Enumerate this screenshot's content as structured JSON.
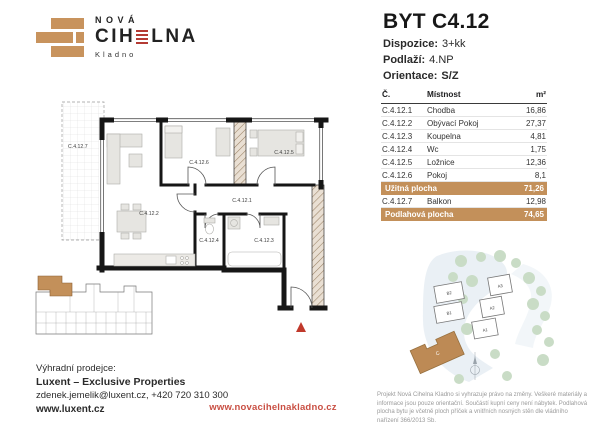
{
  "logo": {
    "line1": "NOVÁ",
    "line2_left": "CIH",
    "line2_right": "LNA",
    "line3": "Kladno"
  },
  "header": {
    "title": "BYT C4.12",
    "dispozice_label": "Dispozice:",
    "dispozice_value": "3+kk",
    "podlazi_label": "Podlaží:",
    "podlazi_value": "4.NP",
    "orientace_label": "Orientace:",
    "orientace_value": "S/Z"
  },
  "table": {
    "col_no": "Č.",
    "col_room": "Místnost",
    "col_area": "m²",
    "rows": [
      {
        "no": "C.4.12.1",
        "room": "Chodba",
        "area": "16,86"
      },
      {
        "no": "C.4.12.2",
        "room": "Obývací Pokoj",
        "area": "27,37"
      },
      {
        "no": "C.4.12.3",
        "room": "Koupelna",
        "area": "4,81"
      },
      {
        "no": "C.4.12.4",
        "room": "Wc",
        "area": "1,75"
      },
      {
        "no": "C.4.12.5",
        "room": "Ložnice",
        "area": "12,36"
      },
      {
        "no": "C.4.12.6",
        "room": "Pokoj",
        "area": "8,1"
      }
    ],
    "usable": {
      "label": "Užitná plocha",
      "area": "71,26"
    },
    "balcony": {
      "no": "C.4.12.7",
      "room": "Balkon",
      "area": "12,98"
    },
    "floor": {
      "label": "Podlahová plocha",
      "area": "74,65"
    }
  },
  "plan": {
    "labels": {
      "balcony": "C.4.12.7",
      "living": "C.4.12.2",
      "room": "C.4.12.6",
      "bedroom": "C.4.12.5",
      "hall": "C.4.12.1",
      "wc": "C.4.12.4",
      "bath": "C.4.12.3"
    }
  },
  "siteplan": {
    "buildings": [
      "B2",
      "B1",
      "A3",
      "A2",
      "A1"
    ],
    "highlight": "C"
  },
  "footer": {
    "seller_label": "Výhradní prodejce:",
    "seller_name": "Luxent – Exclusive Properties",
    "contact": "zdenek.jemelik@luxent.cz, +420 720 310 300",
    "seller_web": "www.luxent.cz",
    "project_web": "www.novacihelnakladno.cz",
    "disclaimer": "Projekt Nová Cihelna Kladno si vyhrazuje právo na změny. Veškeré materiály a informace jsou pouze orientační. Součástí kupní ceny není nábytek. Podlahová plocha bytu je včetně ploch příček a vnitřních nosných stěn dle vládního nařízení 366/2013 Sb."
  },
  "colors": {
    "tan": "#c3905a",
    "red": "#bf4136"
  }
}
